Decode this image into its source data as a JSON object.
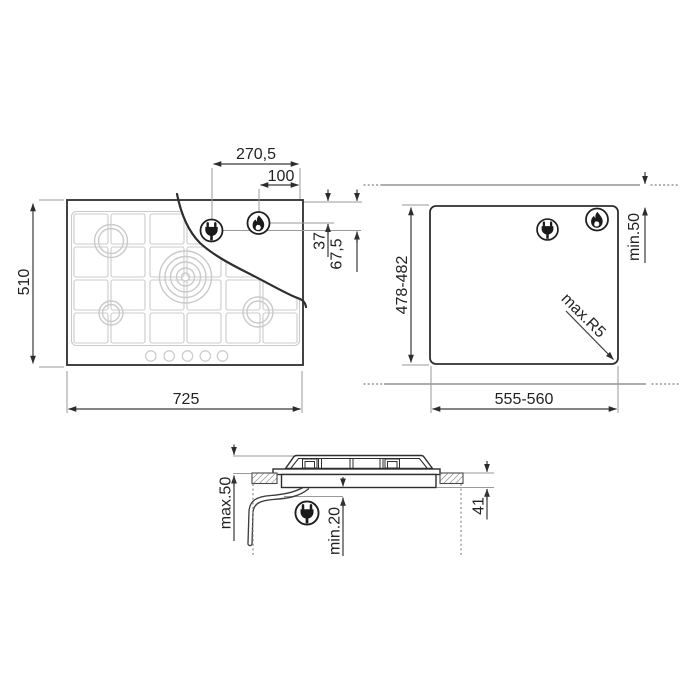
{
  "drawing": {
    "hob_top_view": {
      "overall_width": "725",
      "overall_depth": "510",
      "electrical_connection_from_right": "270,5",
      "gas_connection_from_right": "100",
      "gas_connection_from_top": "37",
      "electrical_connection_from_top": "67,5",
      "burner_count": 5,
      "knob_count": 5
    },
    "cutout_view": {
      "cutout_width": "555-560",
      "cutout_depth": "478-482",
      "rear_clearance": "min.50",
      "max_corner_radius": "max.R5"
    },
    "section_view": {
      "max_worktop_thickness": "max.50",
      "min_bottom_clearance": "min.20",
      "built_in_depth": "41"
    },
    "icons": {
      "plug": "plug-icon",
      "flame": "flame-icon"
    },
    "colors": {
      "outline": "#2e2e2e",
      "dimension": "#3a3a3a",
      "reference": "#9a9a9a",
      "grid": "#c9cbca",
      "background": "#ffffff"
    }
  }
}
